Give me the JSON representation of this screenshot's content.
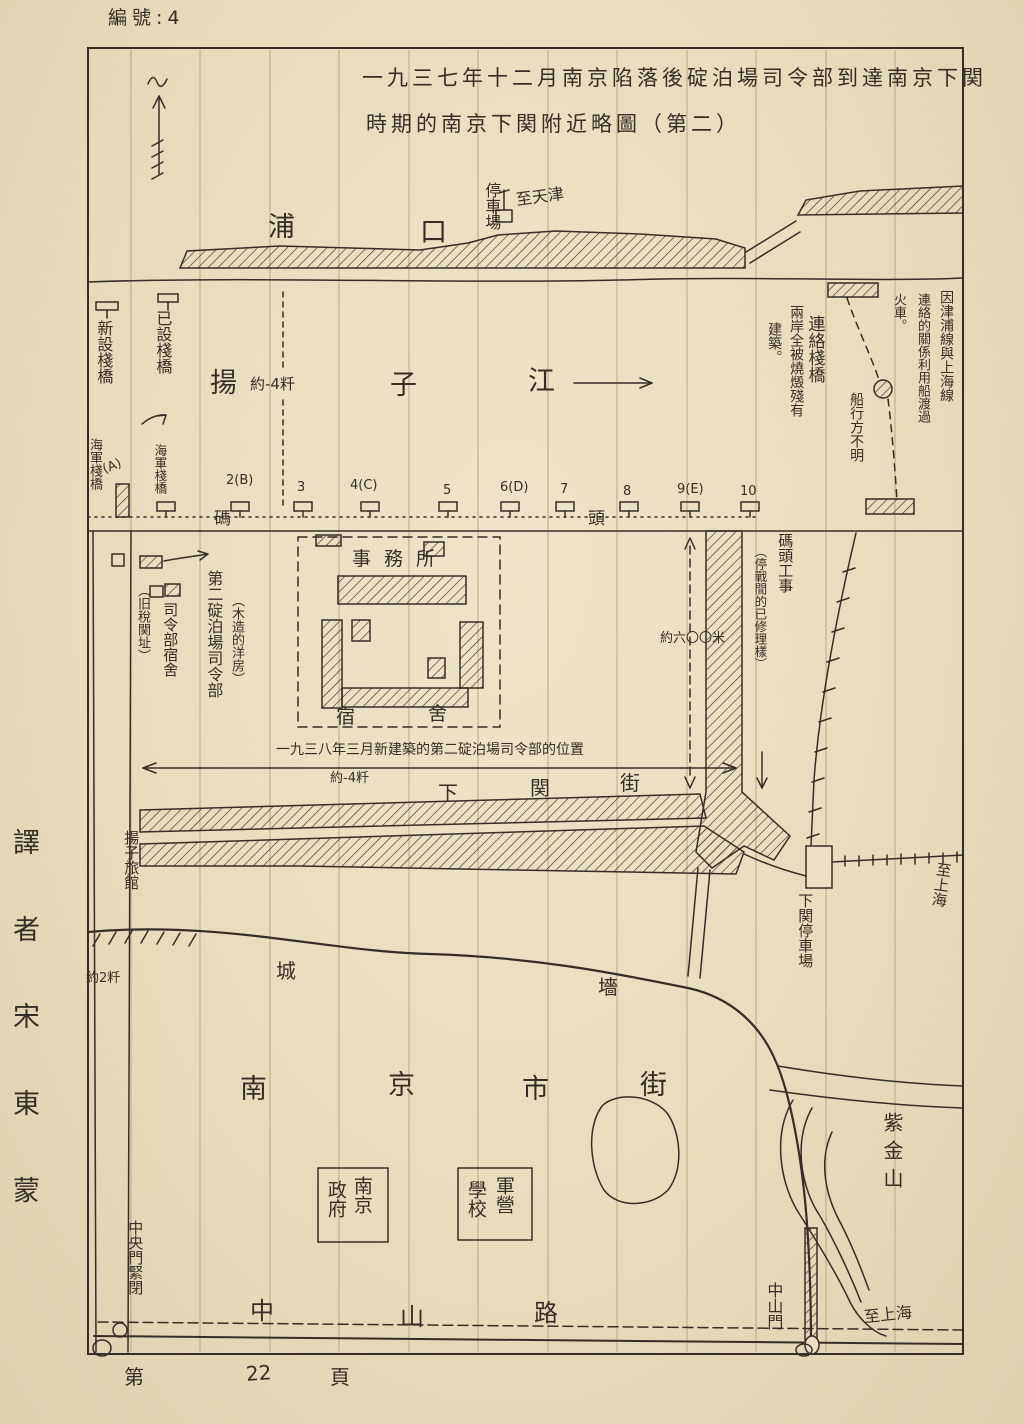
{
  "page": {
    "doc_number": "編號:4",
    "translator_vertical": "譯者宋東蒙",
    "footer": {
      "prefix": "第",
      "page_num": "22",
      "suffix": "頁"
    }
  },
  "title": {
    "line1": "一九三七年十二月南京陷落後碇泊場司令部到達南京下関",
    "line2": "時期的南京下関附近略圖（第二）"
  },
  "north_bank": {
    "pukou": [
      "浦",
      "口"
    ],
    "station_vertical": "停車場",
    "to_tianjin": "至天津"
  },
  "river": {
    "yangtze": [
      "揚",
      "子",
      "江"
    ],
    "width_note": "約-4粁"
  },
  "west_piers": {
    "new_pier": "新設棧橋",
    "existing_pier": "已設棧橋",
    "navy_pier_left": "海軍棧橋",
    "navy_pier_right": "海軍棧橋",
    "label_a": "(A)"
  },
  "pier_row": {
    "wharf_char_left": "碼",
    "wharf_char_right": "頭",
    "numbers": [
      "2(B)",
      "3",
      "4(C)",
      "5",
      "6(D)",
      "7",
      "8",
      "9(E)",
      "10"
    ]
  },
  "ferry": {
    "liaison_bridge": "連絡棧橋",
    "ship_unknown": "船行方不明",
    "banks_burned_1": "兩岸全被燒燬殘有",
    "banks_burned_2": "建築。",
    "jinpu_1": "因津浦線與上海線",
    "jinpu_2": "連絡的關係利用船渡過",
    "jinpu_3": "火車。"
  },
  "hq": {
    "hq_label": "第二碇泊場司令部",
    "hq_paren": "（木造的洋房）",
    "dorm_label": "司令部宿舍",
    "dorm_paren": "（旧稅関址）",
    "office": "事務所",
    "dorm_chars": [
      "宿",
      "舍"
    ],
    "new_site_line": "一九三八年三月新建築的第二碇泊場司令部的位置",
    "new_site_dist": "約-4粁",
    "dist_note": "約六〇〇米",
    "wharf_works": "碼頭工事",
    "wharf_works_paren": "（停戰間的已修理樣）"
  },
  "south": {
    "xiaguan_street": [
      "下",
      "関",
      "街"
    ],
    "xiaguan_station": "下関停車場",
    "to_shanghai_rail": "至上海",
    "hotel": "揚子旅館",
    "dist_2km": "約2粁",
    "wall_chars": [
      "城",
      "墻"
    ],
    "city_street": [
      "南",
      "京",
      "市",
      "街"
    ],
    "govt_box": [
      "南京",
      "政府"
    ],
    "camp_box": [
      "軍營",
      "學校"
    ],
    "zhongshan_road": [
      "中",
      "山",
      "路"
    ],
    "zhongshan_gate": "中山門",
    "central_gate": "中央門緊閉",
    "purple_mountain": "紫金山",
    "to_shanghai_road": "至上海"
  }
}
